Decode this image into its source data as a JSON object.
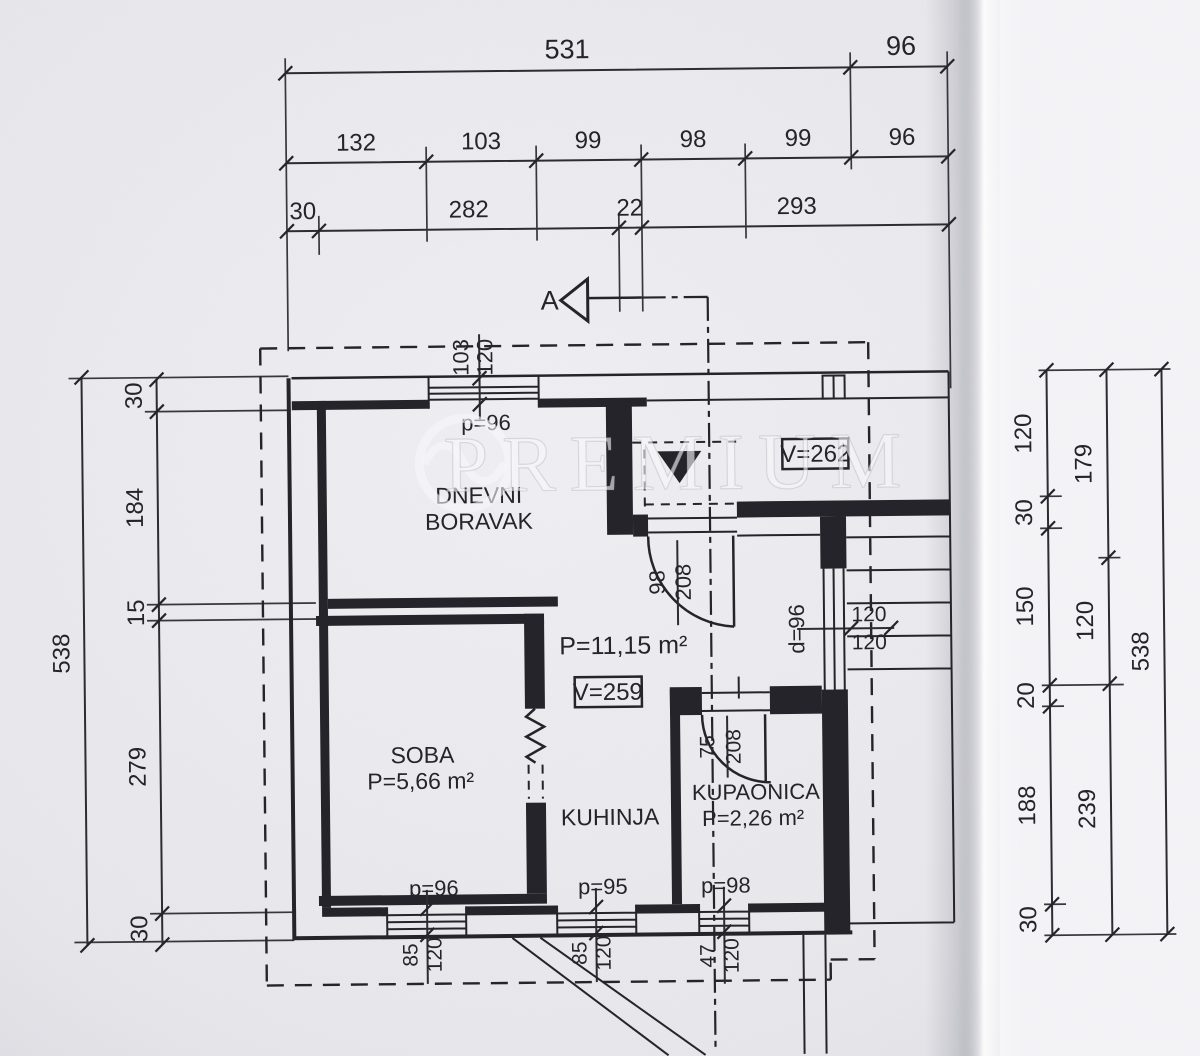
{
  "colors": {
    "paper": "#e9e9ed",
    "ink": "#222228",
    "paper_fold": "#f6f6f8"
  },
  "watermark": {
    "text": "PREMIUM"
  },
  "section": {
    "label": "A"
  },
  "labels": {
    "v_hall": "V=262",
    "v_kitchen": "V=259"
  },
  "rooms": {
    "living": {
      "line1": "DNEVNI",
      "line2": "BORAVAK"
    },
    "soba": {
      "name": "SOBA",
      "area": "P=5,66 m²"
    },
    "kitchen": {
      "name": "KUHINJA",
      "area": "P=11,15 m²"
    },
    "bath": {
      "name": "KUPAONICA",
      "area": "P=2,26 m²"
    }
  },
  "openings": {
    "top_window": {
      "sill": "p=96",
      "width": "103",
      "height": "120"
    },
    "entry_door": {
      "width": "98",
      "height": "208"
    },
    "stair_door": {
      "label": "d=96"
    },
    "bath_door": {
      "width": "75",
      "height": "208"
    },
    "window_sw": {
      "sill": "p=96",
      "width": "85",
      "height": "120"
    },
    "window_s": {
      "sill": "p=95",
      "width": "85",
      "height": "120"
    },
    "window_bath": {
      "sill": "p=98",
      "width": "47",
      "height": "120"
    }
  },
  "dims": {
    "top_row1": [
      "531",
      "96"
    ],
    "top_row2": [
      "132",
      "103",
      "99",
      "98",
      "99",
      "96"
    ],
    "top_row3": [
      "30",
      "282",
      "22",
      "293"
    ],
    "left_total": "538",
    "left_inner": [
      "30",
      "184",
      "15",
      "279",
      "30"
    ],
    "right_inner": [
      "120",
      "30",
      "150",
      "20",
      "188",
      "30"
    ],
    "right_mid": [
      "179",
      "120",
      "239"
    ],
    "right_total": "538",
    "stair_flights": [
      "120",
      "120"
    ]
  }
}
